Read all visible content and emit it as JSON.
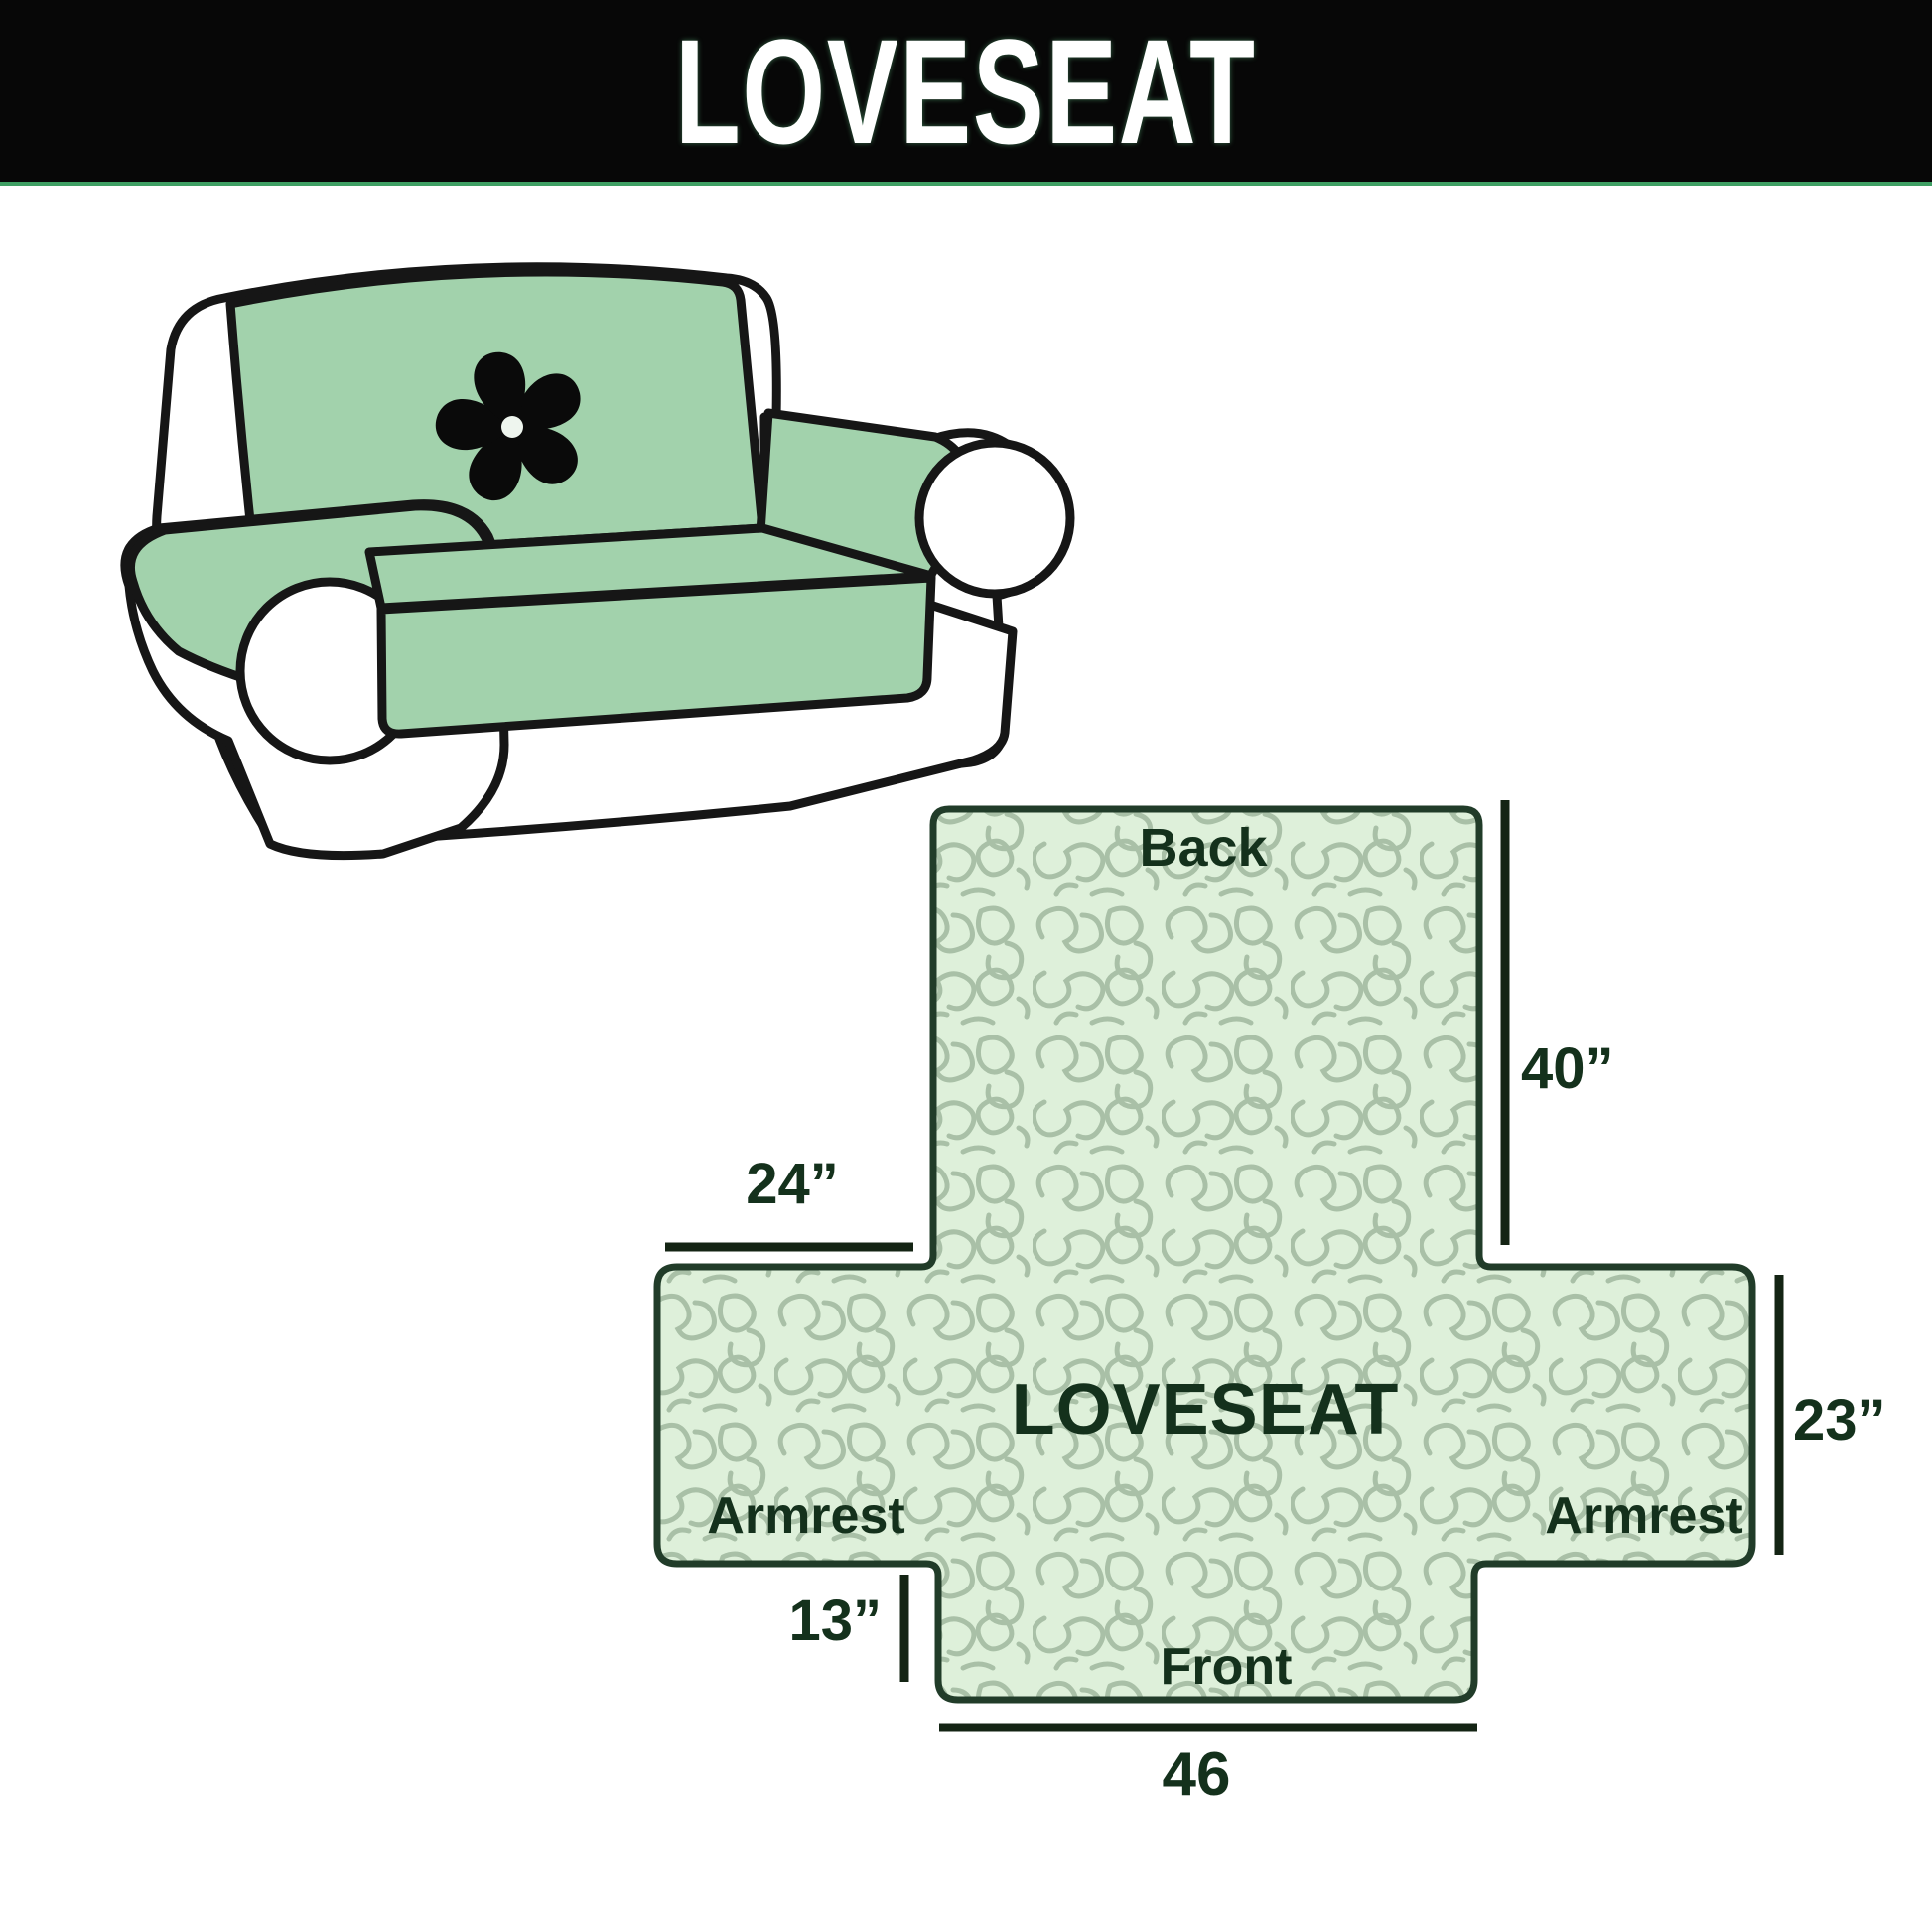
{
  "header": {
    "title": "LOVESEAT"
  },
  "illustration": {
    "cover_color": "#a2d2ac",
    "outline_color": "#161616",
    "logo_icon": "pinwheel-icon"
  },
  "diagram": {
    "fill_color": "#def0da",
    "pattern_color": "#a9c0a7",
    "outline_color": "#213c29",
    "text_color": "#14311c",
    "labels": {
      "back": "Back",
      "center": "LOVESEAT",
      "armrest_left": "Armrest",
      "armrest_right": "Armrest",
      "front": "Front"
    },
    "dimensions": {
      "back_height": "40”",
      "back_top_width": "24”",
      "armrest_height": "23”",
      "front_drop": "13”",
      "front_width": "46"
    }
  }
}
